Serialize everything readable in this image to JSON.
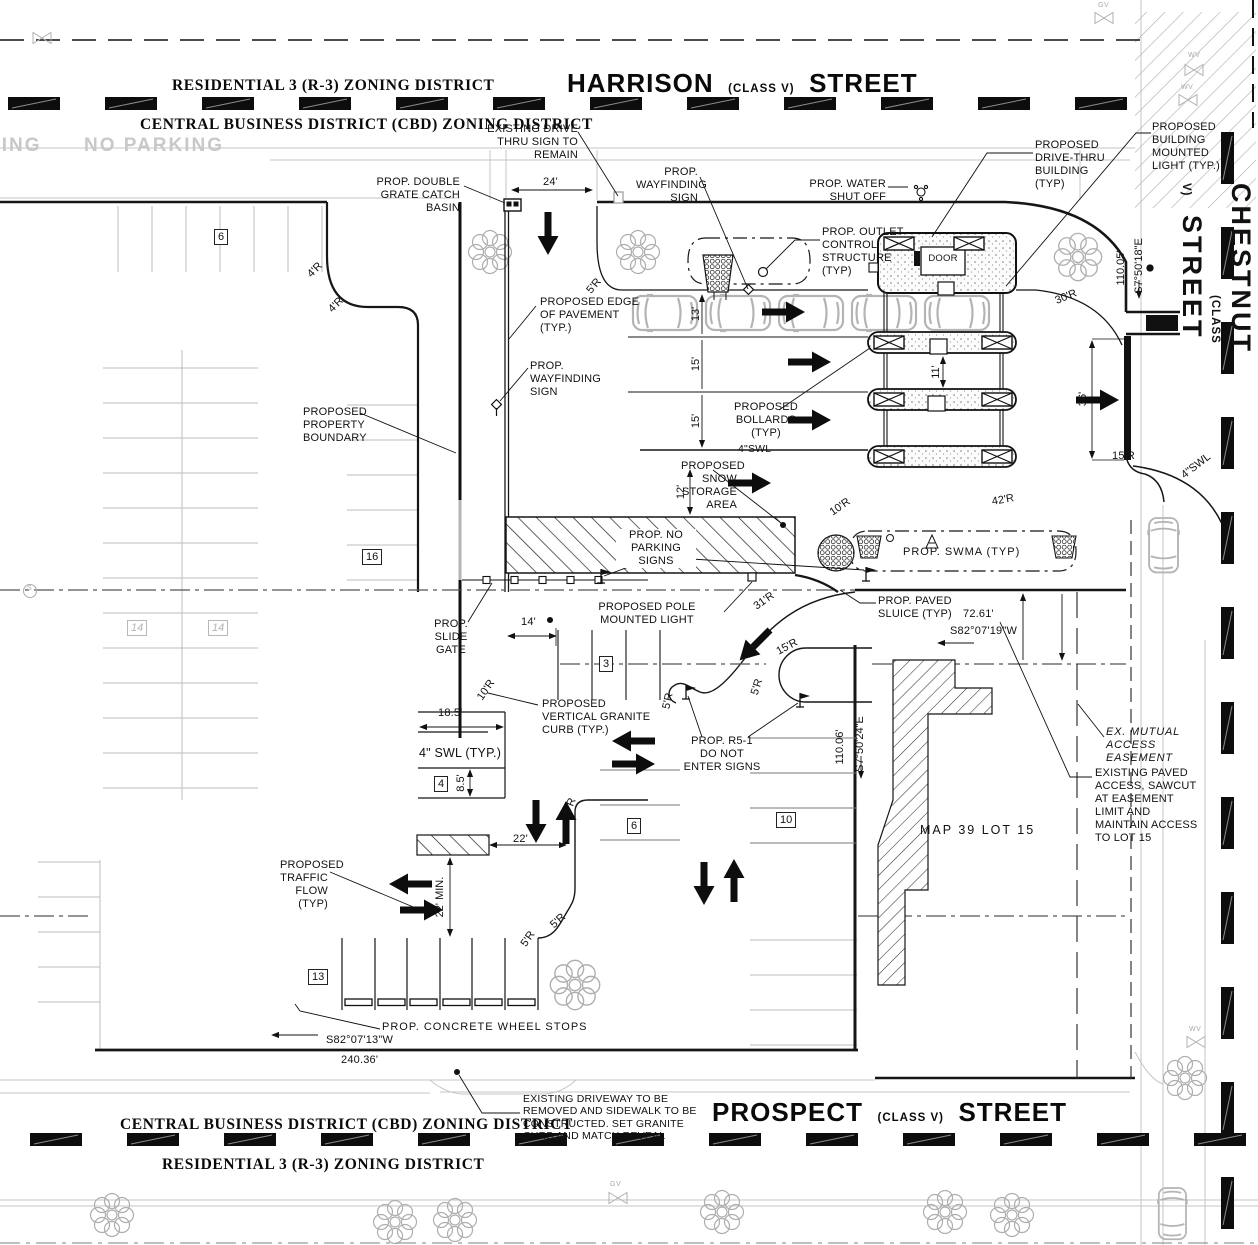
{
  "streets": {
    "harrison": {
      "name": "HARRISON",
      "cls": "(CLASS V)",
      "type": "STREET"
    },
    "prospect": {
      "name": "PROSPECT",
      "cls": "(CLASS V)",
      "type": "STREET"
    },
    "chestnut": {
      "name": "CHESTNUT",
      "cls": "(CLASS V)",
      "type": "STREET"
    }
  },
  "zoning": {
    "top_residential": "RESIDENTIAL 3 (R-3) ZONING DISTRICT",
    "top_cbd": "CENTRAL BUSINESS DISTRICT (CBD) ZONING DISTRICT",
    "bottom_cbd": "CENTRAL BUSINESS DISTRICT (CBD) ZONING DISTRICT",
    "bottom_residential": "RESIDENTIAL 3 (R-3) ZONING DISTRICT"
  },
  "road_markings": {
    "no_parking": "NO PARKING",
    "no_parking_partial": "KING"
  },
  "callouts": {
    "existing_drive_thru_sign": "EXISTING DRIVE\nTHRU SIGN TO\nREMAIN",
    "double_grate": "PROP. DOUBLE\nGRATE CATCH BASIN",
    "wayfinding": "PROP.\nWAYFINDING\nSIGN",
    "water_shut_off": "PROP. WATER\nSHUT OFF",
    "drive_thru_building": "PROPOSED\nDRIVE-THRU\nBUILDING\n(TYP)",
    "building_mounted_light": "PROPOSED\nBUILDING\nMOUNTED\nLIGHT (TYP.)",
    "outlet_control": "PROP. OUTLET\nCONTROL\nSTRUCTURE\n(TYP)",
    "edge_of_pavement": "PROPOSED EDGE\nOF PAVEMENT\n(TYP.)",
    "property_boundary": "PROPOSED\nPROPERTY\nBOUNDARY",
    "bollards": "PROPOSED\nBOLLARDS\n(TYP)",
    "snow_storage": "PROPOSED\nSNOW\nSTORAGE\nAREA",
    "no_parking_signs": "PROP. NO\nPARKING\nSIGNS",
    "swma": "PROP. SWMA (TYP)",
    "paved_sluice": "PROP. PAVED\nSLUICE (TYP)",
    "pole_light": "PROPOSED POLE\nMOUNTED LIGHT",
    "slide_gate": "PROP.\nSLIDE\nGATE",
    "granite_curb": "PROPOSED\nVERTICAL GRANITE\nCURB  (TYP.)",
    "r5_1": "PROP. R5-1\nDO NOT\nENTER SIGNS",
    "mutual_easement": "EX. MUTUAL\nACCESS\nEASEMENT",
    "paved_access": "EXISTING PAVED\nACCESS, SAWCUT\nAT EASEMENT\nLIMIT AND\nMAINTAIN ACCESS\nTO LOT 15",
    "traffic_flow": "PROPOSED\nTRAFFIC\nFLOW\n(TYP)",
    "wheel_stops": "PROP. CONCRETE WHEEL STOPS",
    "driveway_note": "EXISTING DRIVEWAY TO BE\nREMOVED AND SIDEWALK TO BE\nCONSTRUCTED. SET GRANITE\nCURB AND MATCH REVEAL",
    "map_lot": "MAP 39 LOT 15",
    "door": "DOOR"
  },
  "dimensions": {
    "d24": "24'",
    "d13": "13'",
    "d15": "15'",
    "d11": "11'",
    "d36": "36'",
    "d12": "12'",
    "d14": "14'",
    "d18_5": "18.5'",
    "d8_5": "8.5'",
    "d22": "22'",
    "d22_min": "22' MIN.",
    "d72_61": "72.61'",
    "d110_05": "110.05'",
    "d110_06": "110.06'",
    "d240_36": "240.36'"
  },
  "radii": {
    "r4": "4'R",
    "r5": "5'R",
    "r10": "10'R",
    "r15": "15'R",
    "r30": "30'R",
    "r31": "31'R",
    "r42": "42'R"
  },
  "bearings": {
    "s82_07_19w": "S82°07'19\"W",
    "s82_07_13w": "S82°07'13\"W",
    "s7_50_18e": "S7°50'18\"E",
    "s7_50_24e": "S7°50'24\"E"
  },
  "swl": {
    "swl": "4\"SWL",
    "swl_typ": "4\" SWL (TYP.)"
  },
  "stalls": [
    "6",
    "16",
    "14",
    "14",
    "3",
    "4",
    "6",
    "10",
    "13"
  ],
  "utilities": {
    "gv": "GV",
    "wv": "WV",
    "s": "S"
  },
  "colors": {
    "ink": "#1a1a1a",
    "existing_gray": "#bdbdbd",
    "ghost_gray": "#c8c8c8"
  }
}
